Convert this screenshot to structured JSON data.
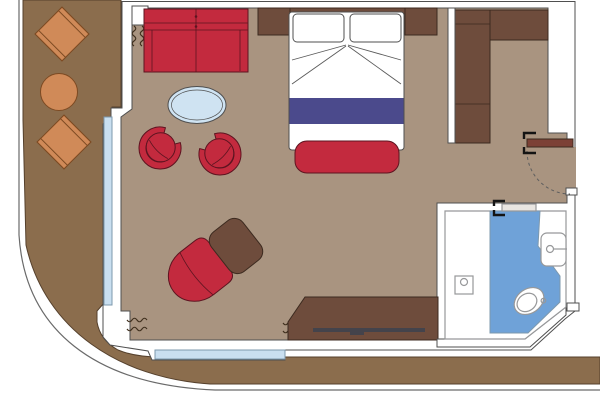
{
  "title": "Ship suite cabin floor plan",
  "colors": {
    "page_bg": "#ffffff",
    "deck": "#8b6d4d",
    "floor": "#a99480",
    "wall_fill": "#ffffff",
    "red": "#c32a3e",
    "dark_wood": "#6e4c3c",
    "orange": "#d08a58",
    "glass_table": "#cfe3f2",
    "window": "#c9dff0",
    "bed_white": "#ffffff",
    "bed_band": "#4b4a8c",
    "bath_floor": "#6fa2d8",
    "bath_white": "#ffffff",
    "entry_door": "#7c4136",
    "bath_door": "#e8e5e1",
    "tv_bar": "#44434b"
  },
  "rooms": [
    {
      "id": "balcony",
      "label": "Balcony deck"
    },
    {
      "id": "bedroom-living",
      "label": "Bedroom / living area"
    },
    {
      "id": "bathroom",
      "label": "Bathroom"
    },
    {
      "id": "entry",
      "label": "Entry corridor"
    }
  ],
  "items": [
    {
      "id": "deck-chair-1",
      "label": "Balcony chair"
    },
    {
      "id": "deck-chair-2",
      "label": "Balcony chair"
    },
    {
      "id": "deck-table",
      "label": "Balcony round table"
    },
    {
      "id": "sofa",
      "label": "Two-seat sofa"
    },
    {
      "id": "nightstand-left",
      "label": "Nightstand"
    },
    {
      "id": "nightstand-right",
      "label": "Nightstand"
    },
    {
      "id": "double-bed",
      "label": "Double bed with pillows and runner band"
    },
    {
      "id": "foot-bench",
      "label": "Bed foot bench"
    },
    {
      "id": "coffee-table",
      "label": "Oval glass coffee table"
    },
    {
      "id": "tub-chair-1",
      "label": "Tub chair"
    },
    {
      "id": "tub-chair-2",
      "label": "Tub chair"
    },
    {
      "id": "armchair",
      "label": "Armchair"
    },
    {
      "id": "ottoman",
      "label": "Ottoman"
    },
    {
      "id": "desk",
      "label": "Desk / TV console"
    },
    {
      "id": "tv",
      "label": "TV bar"
    },
    {
      "id": "wardrobe",
      "label": "L-shaped wardrobe"
    },
    {
      "id": "entry-door",
      "label": "Entry door with swing arc"
    },
    {
      "id": "bathroom-door",
      "label": "Bathroom sliding door"
    },
    {
      "id": "shower-drain",
      "label": "Shower drain"
    },
    {
      "id": "toilet",
      "label": "Toilet"
    },
    {
      "id": "sink",
      "label": "Washbasin"
    },
    {
      "id": "window-left",
      "label": "Balcony window (left)"
    },
    {
      "id": "window-bottom",
      "label": "Balcony window (bottom)"
    },
    {
      "id": "curtains",
      "label": "Curtain symbols (3 sets)"
    }
  ]
}
